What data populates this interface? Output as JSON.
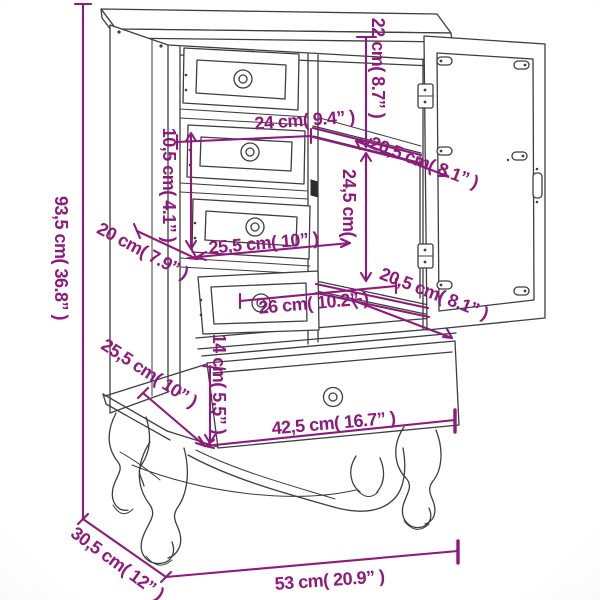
{
  "diagram": {
    "type": "furniture-dimension-diagram",
    "subject": "cabinet with drawers and glass door, open door, cabriole legs",
    "background_color": "#ffffff",
    "drawing_line_color": "#3e3e3e",
    "dimension_color": "#8e1a7c",
    "measurements": {
      "total_height": "93,5 cm( 36.8” )",
      "top_section_height": "22 cm( 8.7” )",
      "upper_drawer_width": "24 cm( 9.4” )",
      "upper_drawer_height": "10,5 cm( 4.1” )",
      "upper_shelf_depth": "20,5 cm( 8.1” )",
      "door_interior_height": "24,5 cm(",
      "top_depth": "20 cm( 7.9” )",
      "middle_drawer_width": "25,5 cm( 10” )",
      "lower_drawer_width": "26 cm( 10.2” )",
      "lower_shelf_depth": "20,5 cm( 8.1” )",
      "bottom_drawer_height": "14 cm( 5.5” )",
      "base_depth": "25,5 cm( 10” )",
      "bottom_drawer_width": "42,5 cm( 16.7” )",
      "overall_depth": "30,5 cm( 12” )",
      "overall_width": "53 cm( 20.9” )"
    }
  }
}
